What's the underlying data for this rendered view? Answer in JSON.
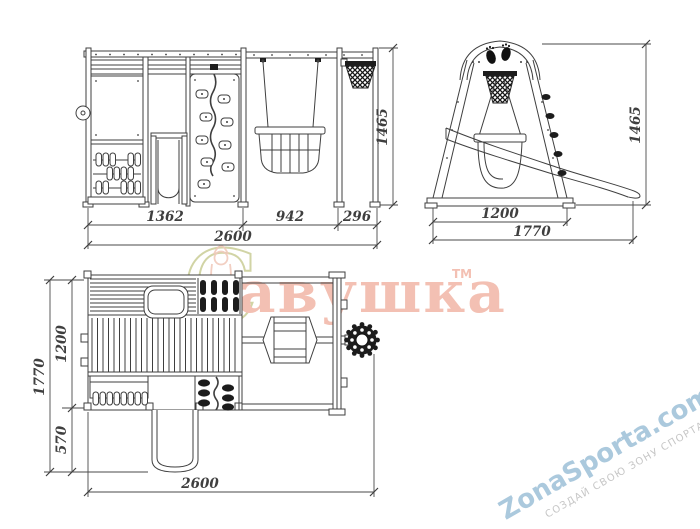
{
  "document_type": "playground technical drawing, three orthographic views",
  "drawing_views": {
    "front": {
      "dim_left_section": "1362",
      "dim_swing_section": "942",
      "dim_hoop_section": "296",
      "dim_total_width": "2600",
      "dim_height": "1465"
    },
    "side": {
      "dim_frame_depth": "1200",
      "dim_total_depth": "1770",
      "dim_height": "1465"
    },
    "plan": {
      "dim_frame_depth": "1200",
      "dim_slide_extension": "570",
      "dim_total_depth": "1770",
      "dim_total_width": "2600"
    }
  },
  "watermarks": {
    "brand_initial": "С",
    "brand_text": "авушка",
    "brand_tm": "ТМ",
    "site_text": "ZonaSporta.com",
    "site_slogan": "СОЗДАЙ СВОЮ ЗОНУ СПОРТА"
  },
  "colors": {
    "line": "#3f3f3f",
    "dark_fill": "#1c1c1c",
    "brand_pink": "#f2b6a6",
    "brand_olive": "#c9cd96",
    "site_blue": "#abc9dd",
    "slogan_gray": "#c6c6c6",
    "background": "#ffffff"
  }
}
